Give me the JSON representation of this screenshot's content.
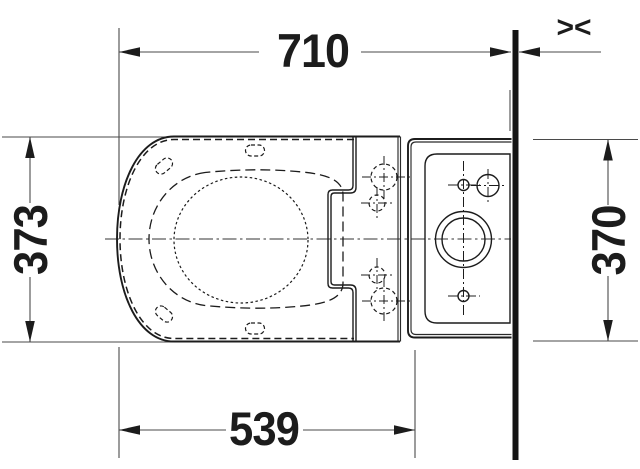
{
  "drawing": {
    "type": "technical-dimension-drawing-top-view",
    "dimensions": {
      "total_depth_to_wall": "710",
      "body_width": "373",
      "tank_width": "370",
      "bowl_depth": "539"
    },
    "wall_symbol": "><",
    "colors": {
      "ink": "#1c1c1c",
      "dimension_line": "#4a4a4a",
      "background": "#ffffff"
    }
  }
}
